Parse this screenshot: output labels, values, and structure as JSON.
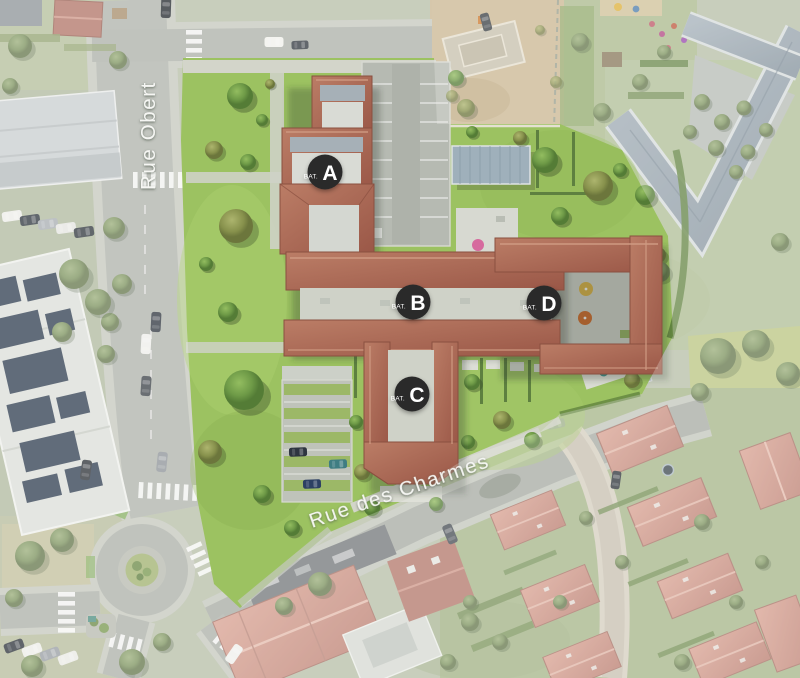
{
  "map": {
    "streets": [
      {
        "name": "Rue Obert"
      },
      {
        "name": "Rue des Charmes"
      }
    ],
    "markers": [
      {
        "prefix": "BAT.",
        "letter": "A"
      },
      {
        "prefix": "BAT.",
        "letter": "B"
      },
      {
        "prefix": "BAT.",
        "letter": "C"
      },
      {
        "prefix": "BAT.",
        "letter": "D"
      }
    ],
    "colors": {
      "marker_bg": "#2b2b2b",
      "marker_text": "#ffffff",
      "street_label": "#f8f9f6",
      "site_lawn": "#9cc261",
      "roof_terracotta": "#a86a57",
      "flat_roof": "#a6b0b7",
      "estate_roof": "#cf9a8d",
      "road": "#b1b5ae",
      "pool": "#4da3cf"
    }
  }
}
